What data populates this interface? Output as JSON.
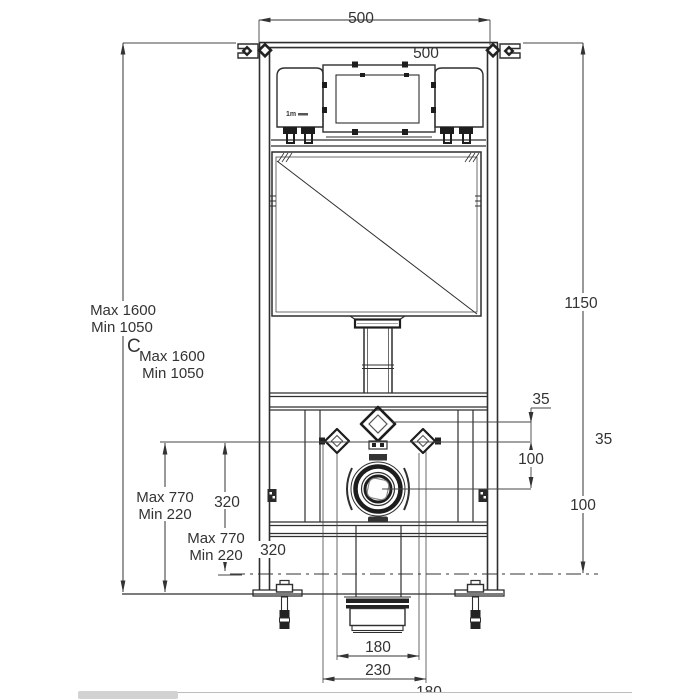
{
  "drawing": {
    "type": "wc-frame-installation-diagram",
    "labels": {
      "width_top": "500",
      "width_inner": "500",
      "height_adjust_max": "Max 1600",
      "height_adjust_min": "Min 1050",
      "datum_c": "C",
      "height_adjust_max_2": "Max 1600",
      "height_adjust_min_2": "Min 1050",
      "frame_height": "1150",
      "offset_35_inner": "35",
      "offset_35_outer": "35",
      "offset_100_inner": "100",
      "offset_100_outer": "100",
      "outlet_max": "Max 770",
      "outlet_min": "Min 220",
      "outlet_rise": "320",
      "outlet_max_2": "Max 770",
      "outlet_min_2": "Min 220",
      "outlet_rise_2": "320",
      "drain_width": "180",
      "drain_spacing": "230",
      "drain_width_2": "180",
      "logo_mark": "1m"
    },
    "colors": {
      "line": "#333333",
      "text": "#333333",
      "background": "#ffffff",
      "scrollbar": "#d2d2d2"
    }
  }
}
